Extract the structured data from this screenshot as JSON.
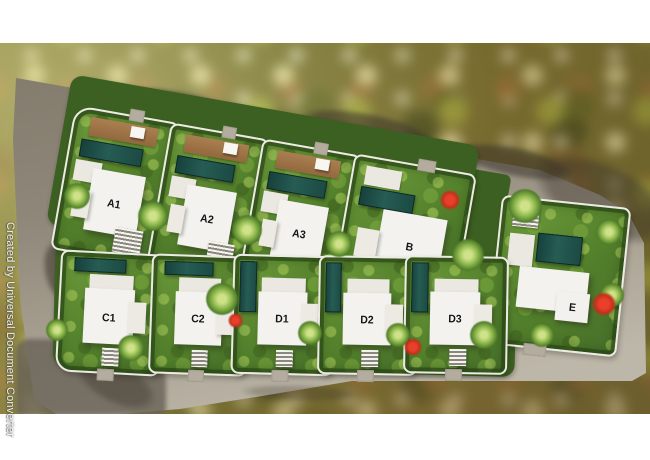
{
  "watermark": {
    "text": "Created by Universal Document Converter"
  },
  "site_plan": {
    "type": "villa-development-masterplan",
    "rows": [
      {
        "name": "upper-row",
        "unit_labels": [
          "A1",
          "A2",
          "A3",
          "B"
        ]
      },
      {
        "name": "lower-row",
        "unit_labels": [
          "C1",
          "C2",
          "D1",
          "D2",
          "D3",
          "E"
        ]
      }
    ],
    "units": [
      {
        "label": "A1"
      },
      {
        "label": "A2"
      },
      {
        "label": "A3"
      },
      {
        "label": "B"
      },
      {
        "label": "C1"
      },
      {
        "label": "C2"
      },
      {
        "label": "D1"
      },
      {
        "label": "D2"
      },
      {
        "label": "D3"
      },
      {
        "label": "E"
      }
    ],
    "features": [
      "swimming-pool",
      "wooden-deck",
      "slatted-pergola",
      "palm-tree",
      "flowering-tree",
      "perimeter-road"
    ]
  },
  "palette": {
    "page_background": "#ffffff",
    "road_dark": "#8a8274",
    "road_light": "#bdb7a9",
    "asphalt": "#6a6257",
    "lawn_green": "#5c8a30",
    "hedge_green": "#3c6021",
    "pool_teal": "#1d4843",
    "villa_white": "#f3f2ee",
    "deck_brown": "#a07749",
    "label_text": "#151515",
    "flower_red": "#cf3520",
    "curb_white": "#ecebe3",
    "watermark_text": "#fafaf6"
  }
}
